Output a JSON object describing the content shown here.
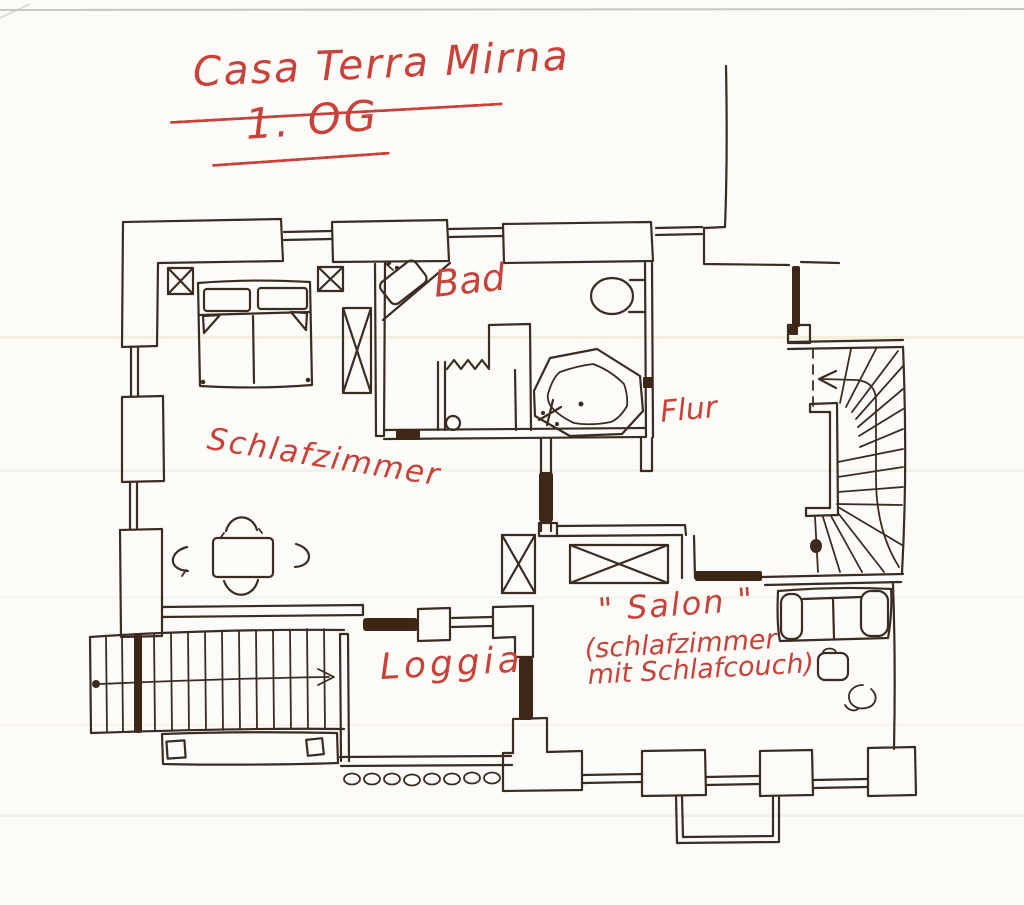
{
  "page": {
    "paper_color": "#fcfbf7",
    "kind": "hand-drawn floor plan sketch"
  },
  "colors": {
    "ink": "#3a2c22",
    "red": "#c9423a",
    "door_fill": "#3f2718",
    "paper": "#fcfbf7"
  },
  "header": {
    "title": "Casa Terra Mirna",
    "floor": "1. OG"
  },
  "rooms": {
    "bedroom": {
      "label": "Schlafzimmer"
    },
    "bathroom": {
      "label": "Bad"
    },
    "hallway": {
      "label": "Flur"
    },
    "salon": {
      "label": "\" Salon \"",
      "sublabel_1": "(schlafzimmer",
      "sublabel_2": "mit Schlafcouch)"
    },
    "loggia": {
      "label": "Loggia"
    }
  },
  "drawing_elements": [
    "double-bed-with-pillows",
    "nightstand-x-boxes",
    "wardrobe-x-box",
    "dining-table-with-four-chairs",
    "washbasin",
    "toilet",
    "bathtub",
    "shower-with-curtain-zigzag",
    "interior-winding-staircase",
    "stair-direction-arrow",
    "exterior-staircase",
    "exterior-stair-arrow",
    "sofa",
    "side-table",
    "plant-squiggle",
    "loggia-balustrade-ovals",
    "french-balcony-railing",
    "window-openings",
    "dark-door-openings"
  ]
}
